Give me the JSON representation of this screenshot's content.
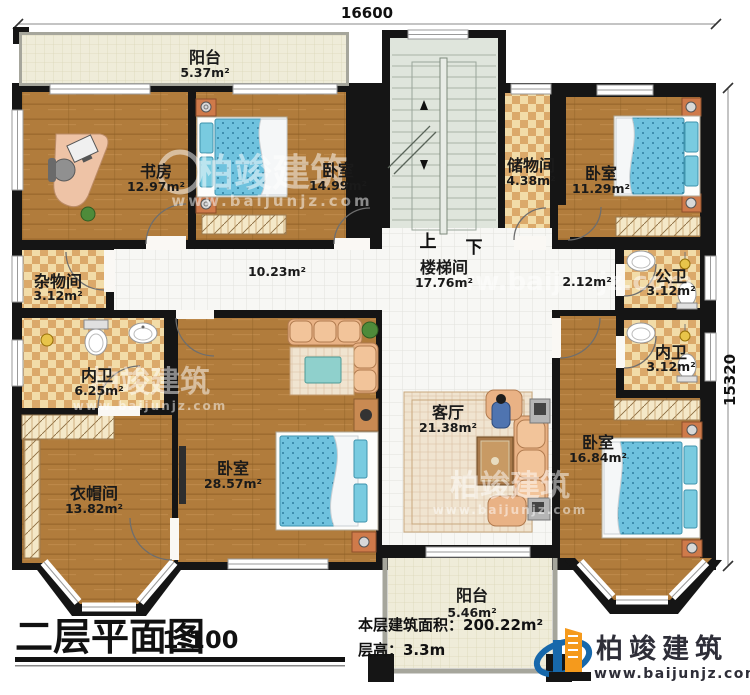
{
  "dimensions": {
    "top": "16600",
    "right": "15320"
  },
  "stairs": {
    "up": "上",
    "down": "下"
  },
  "rooms": [
    {
      "id": "balcony-top",
      "name": "阳台",
      "area": "5.37m²"
    },
    {
      "id": "study",
      "name": "书房",
      "area": "12.97m²"
    },
    {
      "id": "bedroom-top",
      "name": "卧室",
      "area": "14.99m²"
    },
    {
      "id": "stairwell",
      "name": "楼梯间",
      "area": "17.76m²"
    },
    {
      "id": "storage",
      "name": "储物间",
      "area": "4.38m²"
    },
    {
      "id": "bedroom-topright",
      "name": "卧室",
      "area": "11.29m²"
    },
    {
      "id": "utility",
      "name": "杂物间",
      "area": "3.12m²"
    },
    {
      "id": "corridor",
      "name": "",
      "area": "10.23m²"
    },
    {
      "id": "corridor-right",
      "name": "",
      "area": "2.12m²"
    },
    {
      "id": "public-bath",
      "name": "公卫",
      "area": "3.12m²"
    },
    {
      "id": "ensuite-left",
      "name": "内卫",
      "area": "6.25m²"
    },
    {
      "id": "ensuite-right",
      "name": "内卫",
      "area": "3.12m²"
    },
    {
      "id": "cloakroom",
      "name": "衣帽间",
      "area": "13.82m²"
    },
    {
      "id": "bedroom-master",
      "name": "卧室",
      "area": "28.57m²"
    },
    {
      "id": "living-room",
      "name": "客厅",
      "area": "21.38m²"
    },
    {
      "id": "bedroom-bottomright",
      "name": "卧室",
      "area": "16.84m²"
    },
    {
      "id": "balcony-bottom",
      "name": "阳台",
      "area": "5.46m²"
    }
  ],
  "title_block": {
    "title": "二层平面图",
    "scale": "1:100",
    "area_label": "本层建筑面积：200.22m²",
    "height_label": "层高：3.3m"
  },
  "brand": {
    "name": "柏竣建筑",
    "website": "www.baijunjz.com"
  },
  "colors": {
    "wall": "#151515",
    "wood": "#b17c3c",
    "bath_tile": "#dba96a",
    "bed_blue": "#6fc2de",
    "brand_blue": "#1768ab",
    "brand_orange": "#f59a1c"
  }
}
